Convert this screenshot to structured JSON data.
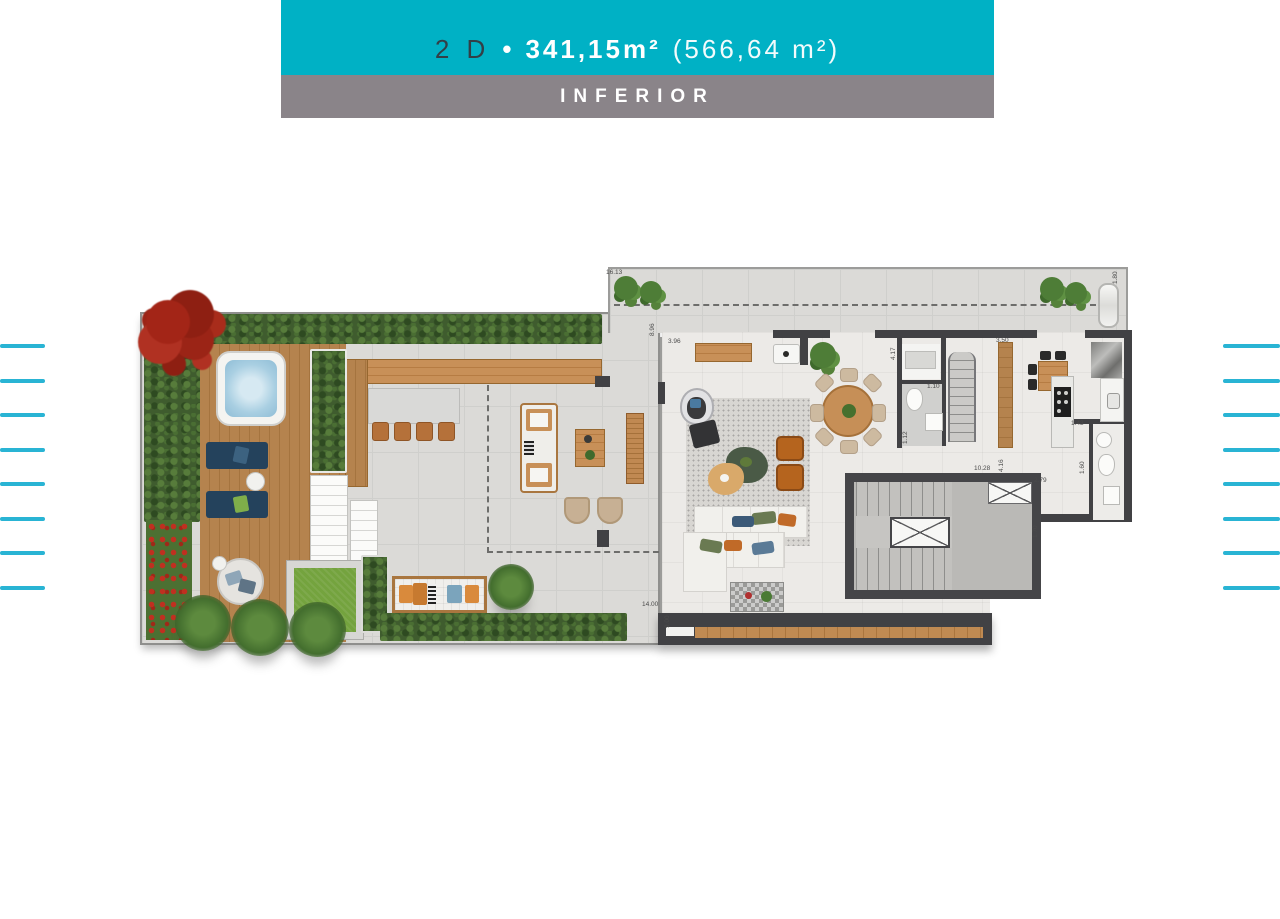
{
  "header": {
    "unit_code": "2 D",
    "bullet": "•",
    "private_area": "341,15m²",
    "total_area": "(566,64 m²)",
    "floor_label": "INFERIOR",
    "banner_color": "#00b1c5",
    "floor_band_color": "#8a8489"
  },
  "decor": {
    "side_line_color": "#29b4d4",
    "side_line_count_left": 8,
    "side_line_count_right": 8
  },
  "plan": {
    "type": "residential floor plan, lower level",
    "wall_color": "#414144",
    "deck_color": "#b5834e",
    "lawn_color": "#74a33e",
    "water_color": "#a9cfe2"
  },
  "dimensions": [
    "16.13",
    "8.96",
    "3.96",
    "4.17",
    "1.10",
    "1.12",
    "3.50",
    "1.80",
    "1.43",
    "1.60",
    "10.28",
    "4.16",
    "2.79",
    "1.70",
    "14.00",
    "9.00"
  ]
}
